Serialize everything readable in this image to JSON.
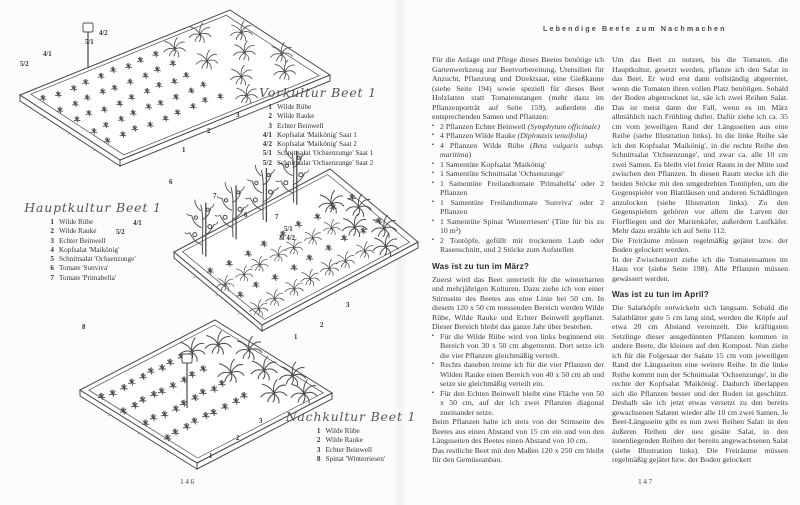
{
  "header": {
    "running_title": "Lebendige Beete zum Nachmachen"
  },
  "left_page": {
    "page_number": "146",
    "beds": [
      {
        "title": "Vorkultur Beet 1",
        "items": [
          {
            "num": "1",
            "label": "Wilde Rübe"
          },
          {
            "num": "2",
            "label": "Wilde Rauke"
          },
          {
            "num": "3",
            "label": "Echter Beinwell"
          },
          {
            "num": "4/1",
            "label": "Kopfsalat 'Maikönig' Saat 1"
          },
          {
            "num": "4/2",
            "label": "Kopfsalat 'Maikönig' Saat 2"
          },
          {
            "num": "5/1",
            "label": "Schnittsalat 'Ochsenzunge' Saat 1"
          },
          {
            "num": "5/2",
            "label": "Schnittsalat 'Ochsenzunge' Saat 2"
          }
        ],
        "ann": [
          "5/2",
          "4/1",
          "5/1",
          "4/2",
          "3",
          "2",
          "1"
        ]
      },
      {
        "title": "Hauptkultur Beet 1",
        "items": [
          {
            "num": "1",
            "label": "Wilde Rübe"
          },
          {
            "num": "2",
            "label": "Wilde Rauke"
          },
          {
            "num": "3",
            "label": "Echter Beinwell"
          },
          {
            "num": "4",
            "label": "Kopfsalat 'Maikönig'"
          },
          {
            "num": "5",
            "label": "Schnittsalat 'Ochsenzunge'"
          },
          {
            "num": "6",
            "label": "Tomate 'Sunviva'"
          },
          {
            "num": "7",
            "label": "Tomate 'Primabella'"
          }
        ],
        "ann": [
          "5/2",
          "4/1",
          "6",
          "7",
          "6",
          "7",
          "5/1",
          "& 4/2",
          "3",
          "2",
          "1"
        ]
      },
      {
        "title": "Nachkultur Beet 1",
        "items": [
          {
            "num": "1",
            "label": "Wilde Rübe"
          },
          {
            "num": "2",
            "label": "Wilde Rauke"
          },
          {
            "num": "3",
            "label": "Echter Beinwell"
          },
          {
            "num": "8",
            "label": "Spinat 'Winterriesen'"
          }
        ],
        "ann": [
          "8",
          "3",
          "2",
          "1"
        ]
      }
    ]
  },
  "right_page": {
    "page_number": "147",
    "col1": {
      "intro": "Für die Anlage und Pflege dieses Beetes benötige ich Gartenwerkzeug zur Beetvorbereitung, Utensilien für Anzucht, Pflanzung und Direktsaat, eine Gießkanne (siehe Seite 194) sowie speziell für dieses Beet Holzlatten statt Tomatenstangen (mehr dazu im Pflanzenporträt auf Seite 159), außerdem die entsprechenden Samen und Pflanzen:",
      "supplies": [
        {
          "t": "2 Pflanzen Echter Beinwell ",
          "i": "(Symphytum officinale)"
        },
        {
          "t": "4 Pflanzen Wilde Rauke ",
          "i": "(Diplotaxis tenuifolia)"
        },
        {
          "t": "4 Pflanzen Wilde Rübe (",
          "i": "Beta vulgaris subsp. maritima",
          "t2": ")"
        },
        {
          "t": "1 Samentüte Kopfsalat 'Maikönig'"
        },
        {
          "t": "1 Samentüte Schnittsalat 'Ochsenzunge'"
        },
        {
          "t": "1 Samentüte Freilandtomate 'Primabella' oder 2 Pflanzen"
        },
        {
          "t": "1 Samentüte Freilandtomate 'Sunviva' oder 2 Pflanzen"
        },
        {
          "t": "1 Samentüte Spinat 'Winterriesen' (Tüte für bis zu 10 m²)"
        },
        {
          "t": "2 Tontöpfe, gefüllt mit trockenem Laub oder Rasenschnitt, und 2 Stöcke zum Aufstellen"
        }
      ],
      "march_heading": "Was ist zu tun im März?",
      "march_intro": "Zuerst wird das Beet unterteilt für die winterharten und mehrjährigen Kulturen. Dazu ziehe ich von einer Stirnseite des Beetes aus eine Linie bei 50 cm. In diesem 120 x 50 cm messenden Bereich werden Wilde Rübe, Wilde Rauke und Echter Beinwell gepflanzt. Dieser Bereich bleibt das ganze Jahr über bestehen.",
      "march_bullets": [
        "Für die Wilde Rübe wird von links beginnend ein Bereich von 30 x 50 cm abgetrennt. Dort setze ich die vier Pflanzen gleichmäßig verteilt.",
        "Rechts daneben trenne ich für die vier Pflanzen der Wilden Rauke einen Bereich von 40 x 50 cm ab und setze sie gleichmäßig verteilt ein.",
        "Für den Echten Beinwell bleibt eine Fläche von 50 x 50 cm, auf der ich zwei Pflanzen diagonal zueinander setze."
      ],
      "march_note": "Beim Pflanzen halte ich stets von der Stirnseite des Beetes aus einen Abstand von 15 cm ein und von den Längsseiten des Beetes einen Abstand von 10 cm.",
      "march_note2": "Das restliche Beet mit den Maßen 120 x 250 cm bleibt für den Gemüseanbau."
    },
    "col2": {
      "p1": "Um das Beet zu nutzen, bis die Tomaten, die Hauptkultur, gesetzt werden, pflanze ich den Salat in das Beet. Er wird erst dann vollständig abgeerntet, wenn die Tomaten ihren vollen Platz benötigen. Sobald der Boden abgetrocknet ist, säe ich zwei Reihen Salat. Das ist meist dann der Fall, wenn es im März allmählich nach Frühling duftet. Dafür ziehe ich ca. 35 cm vom jeweiligen Rand der Längsseiten aus eine Reihe (siehe Illustration links). In die linke Reihe säe ich den Kopfsalat 'Maikönig', in die rechte Reihe den Schnittsalat 'Ochsenzunge', und zwar ca. alle 10 cm zwei Samen. Es bleibt viel freier Raum in der Mitte und zwischen den Pflanzen. In diesen Raum stecke ich die beiden Stöcke mit den umgedrehten Tontöpfen, um die Gegenspieler von Blattläusen und anderen Schädlingen anzulocken (siehe Illustration links). Zu den Gegenspielern gehören vor allem die Larven der Florfliegen und der Marienkäfer, außerdem Laufkäfer. Mehr dazu erzähle ich auf Seite 112.",
      "p2": "Die Freiräume müssen regelmäßig gejätet bzw. der Boden gelockert werden.",
      "p3": "In der Zwischenzeit ziehe ich die Tomatensamen im Haus vor (siehe Seite 198). Alle Pflanzen müssen gewässert werden.",
      "april_heading": "Was ist zu tun im April?",
      "april_p1": "Die Salatköpfe entwickeln sich langsam. Sobald die Salatblätter gute 5 cm lang sind, werden die Köpfe auf etwa 20 cm Abstand vereinzelt. Die kräftigsten Setzlinge dieser ausgedünnten Pflanzen kommen in andere Beete, die kleinen auf den Kompost. Nun ziehe ich für die Folgesaat der Salate 15 cm vom jeweiligen Rand der Längsseiten eine weitere Reihe. In die linke Reihe kommt nun der Schnittsalat 'Ochsenzunge', in die rechte der Kopfsalat 'Maikönig'. Dadurch überlappen sich die Pflanzen besser und der Boden ist geschützt. Deshalb säe ich jetzt etwas versetzt zu den bereits gewachsenen Salaten wieder alle 10 cm zwei Samen. Je Beet-Längsseite gibt es nun zwei Reihen Salat: in den äußeren Reihen der neu gesäte Salat, in den innenliegenden Reihen der bereits angewachsenen Salat (siehe Illustration links). Die Freiräume müssen regelmäßig gejätet bzw. der Boden gelockert"
    }
  }
}
